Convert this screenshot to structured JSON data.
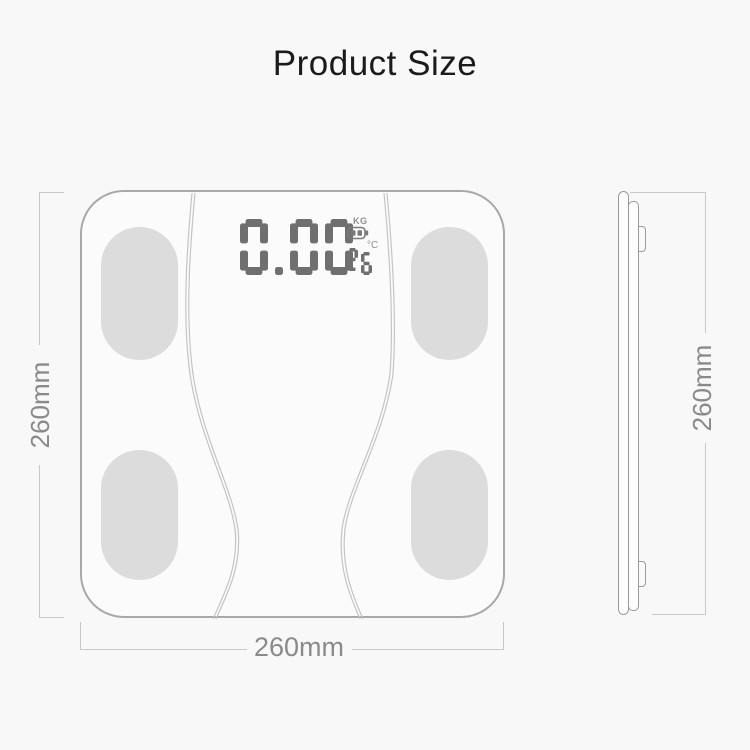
{
  "title": "Product Size",
  "colors": {
    "background": "#f8f8f8",
    "scale_outline": "#a8a8a8",
    "pad_fill": "#dcdcdc",
    "body_curve": "#c4c4c4",
    "dimension_line": "#c9c9c9",
    "dimension_text": "#8a8a8a",
    "lcd_segment": "#6f6f6f"
  },
  "top_view": {
    "lcd": {
      "weight_value": "0.00",
      "weight_unit": "KG",
      "temperature_value": "26",
      "temperature_unit": "°C",
      "battery_icon": "battery-icon"
    },
    "height_dimension": "260mm",
    "width_dimension": "260mm"
  },
  "side_view": {
    "height_dimension": "260mm"
  }
}
